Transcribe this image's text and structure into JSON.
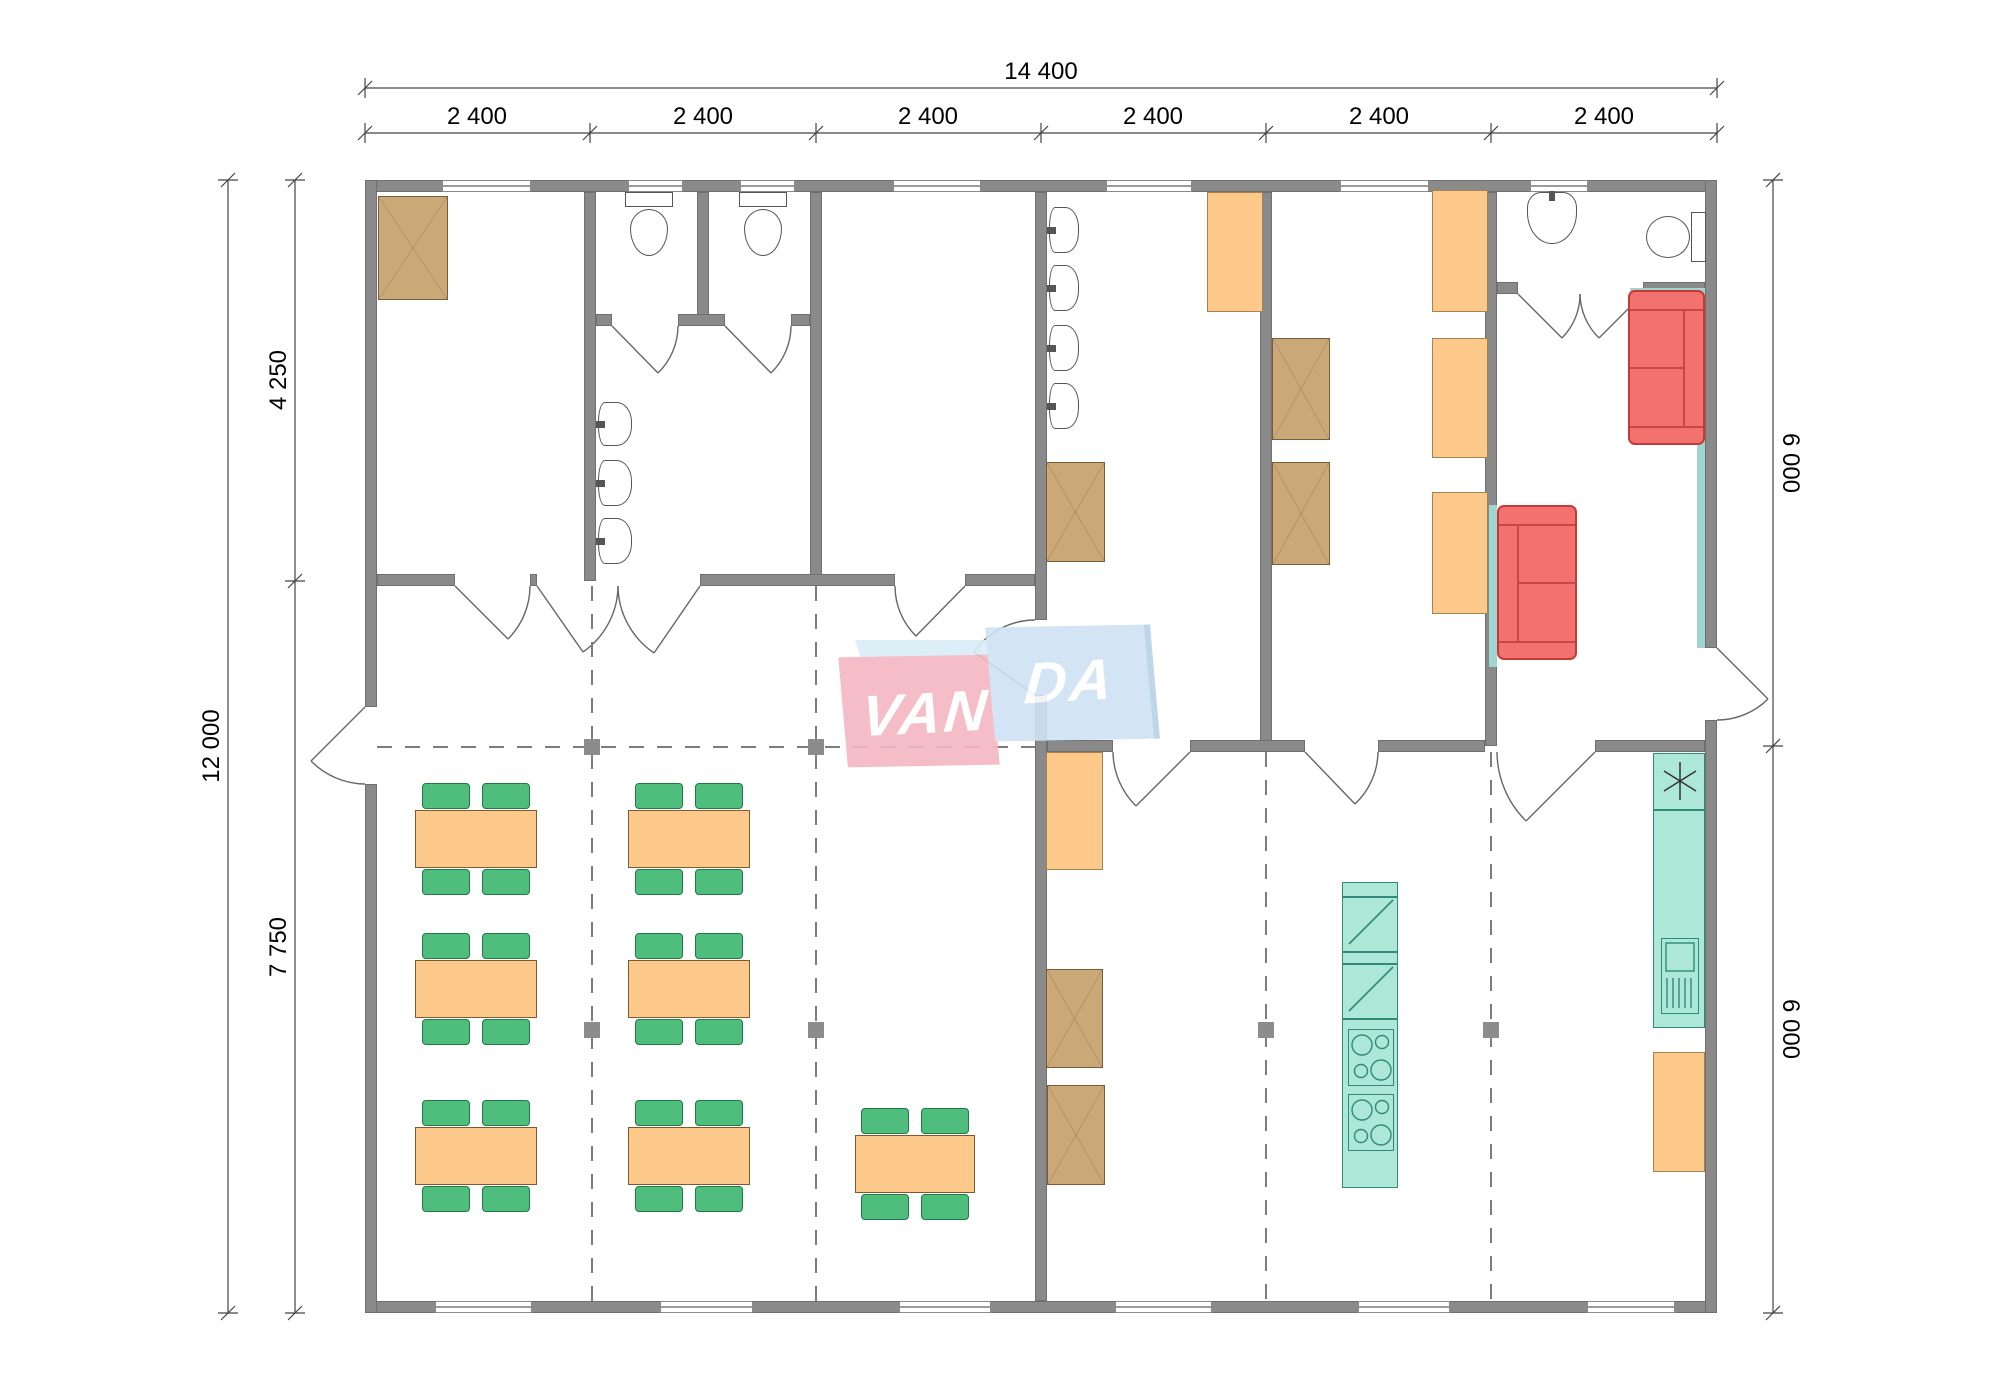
{
  "plan": {
    "watermark": {
      "name": "VANDA",
      "left_text": "VAN",
      "right_text": "DA",
      "pink_color": "#f5b6c2",
      "blue_color": "#cfe2f3",
      "top_face_color": "#d9edf8"
    },
    "dimensions_mm": {
      "top_total": "14 400",
      "top_segments": [
        "2 400",
        "2 400",
        "2 400",
        "2 400",
        "2 400",
        "2 400"
      ],
      "left_total": "12 000",
      "left_upper": "4 250",
      "left_lower": "7 750",
      "right_upper": "6 000",
      "right_lower": "6 000"
    },
    "colors": {
      "wall": "#8a8a8a",
      "wardrobe_wood": "#cba878",
      "furniture_orange": "#fcc98b",
      "chair_green": "#4fbe7c",
      "sofa_red": "#f3716e",
      "kitchen_teal": "#ace7d7",
      "wall_lining_teal": "#9fd6d2"
    },
    "icons": {
      "wardrobe": "crossed-box",
      "fridge": "lightning-diagonal",
      "cooktop": "four-burner-circles",
      "kitchen_sink": "basin-with-drainboard",
      "counter_star": "six-spoke-asterisk",
      "toilet": "tank-and-bowl",
      "wash_basin": "rounded-basin",
      "door": "quarter-circle-arc",
      "window": "triple-line-in-wall",
      "grid_marker": "filled-square"
    }
  }
}
